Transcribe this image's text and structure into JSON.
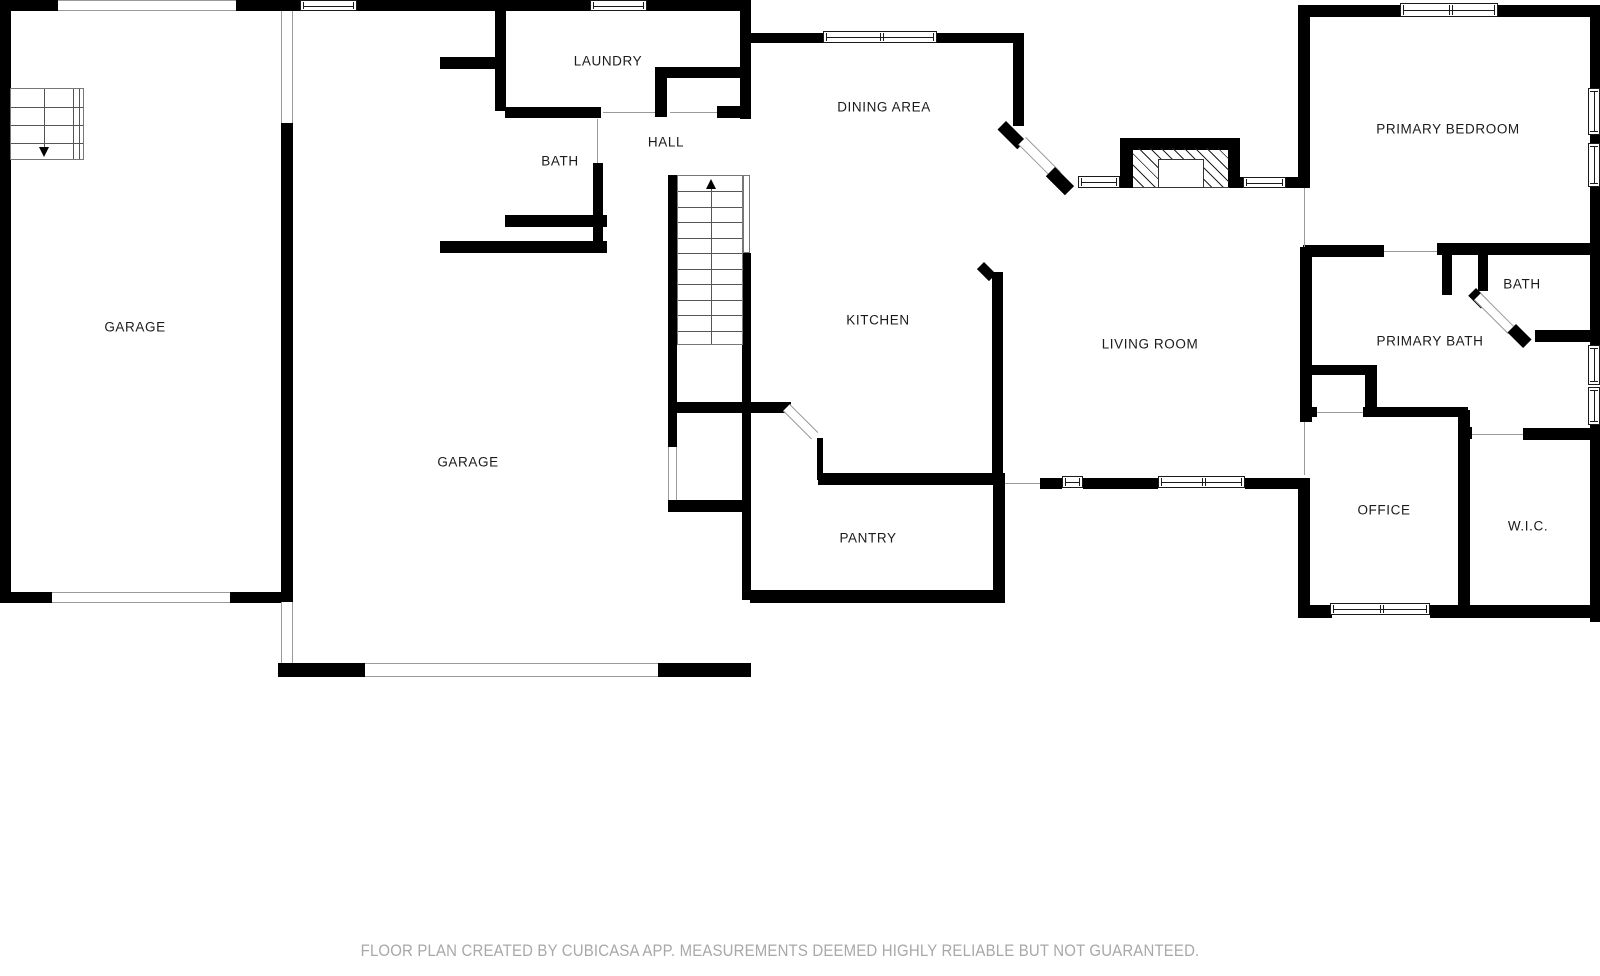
{
  "footer": {
    "text": "FLOOR PLAN CREATED BY CUBICASA APP. MEASUREMENTS DEEMED HIGHLY RELIABLE BUT NOT GUARANTEED."
  },
  "colors": {
    "wall": "#000000",
    "window_frame": "#1a1a1a",
    "opening_line": "#9b9b9b",
    "tread": "#555555",
    "label": "#1b1b1b",
    "footer_text": "#a8a8a8",
    "background": "#ffffff"
  },
  "rooms": [
    {
      "id": "garage-1",
      "label": "GARAGE",
      "x": 135,
      "y": 327
    },
    {
      "id": "garage-2",
      "label": "GARAGE",
      "x": 468,
      "y": 462
    },
    {
      "id": "laundry",
      "label": "LAUNDRY",
      "x": 608,
      "y": 61
    },
    {
      "id": "bath",
      "label": "BATH",
      "x": 560,
      "y": 161
    },
    {
      "id": "hall",
      "label": "HALL",
      "x": 666,
      "y": 142
    },
    {
      "id": "dining-area",
      "label": "DINING AREA",
      "x": 884,
      "y": 107
    },
    {
      "id": "kitchen",
      "label": "KITCHEN",
      "x": 878,
      "y": 320
    },
    {
      "id": "living-room",
      "label": "LIVING ROOM",
      "x": 1150,
      "y": 344
    },
    {
      "id": "pantry",
      "label": "PANTRY",
      "x": 868,
      "y": 538
    },
    {
      "id": "primary-bedroom",
      "label": "PRIMARY BEDROOM",
      "x": 1448,
      "y": 129
    },
    {
      "id": "bath-2",
      "label": "BATH",
      "x": 1522,
      "y": 284
    },
    {
      "id": "primary-bath",
      "label": "PRIMARY BATH",
      "x": 1430,
      "y": 341
    },
    {
      "id": "office",
      "label": "OFFICE",
      "x": 1384,
      "y": 510
    },
    {
      "id": "wic",
      "label": "W.I.C.",
      "x": 1528,
      "y": 526
    }
  ],
  "floorplan": {
    "walls": [
      [
        0,
        0,
        11,
        602
      ],
      [
        0,
        0,
        58,
        11
      ],
      [
        236,
        0,
        64,
        11
      ],
      [
        357,
        0,
        233,
        11
      ],
      [
        647,
        0,
        104,
        11
      ],
      [
        0,
        592,
        52,
        11
      ],
      [
        230,
        592,
        53,
        11
      ],
      [
        281,
        123,
        12,
        484
      ],
      [
        278,
        663,
        88,
        14
      ],
      [
        658,
        663,
        93,
        14
      ],
      [
        495,
        11,
        11,
        100
      ],
      [
        440,
        57,
        56,
        12
      ],
      [
        505,
        107,
        96,
        11
      ],
      [
        655,
        67,
        89,
        11
      ],
      [
        655,
        67,
        12,
        50
      ],
      [
        717,
        106,
        34,
        12
      ],
      [
        740,
        9,
        11,
        110
      ],
      [
        740,
        33,
        84,
        10
      ],
      [
        937,
        33,
        77,
        10
      ],
      [
        1013,
        33,
        11,
        93
      ],
      [
        1120,
        138,
        120,
        12
      ],
      [
        1120,
        145,
        13,
        43
      ],
      [
        1228,
        138,
        12,
        50
      ],
      [
        1285,
        177,
        13,
        11
      ],
      [
        1240,
        177,
        4,
        11
      ],
      [
        1298,
        5,
        104,
        12
      ],
      [
        1496,
        5,
        104,
        12
      ],
      [
        1298,
        5,
        12,
        183
      ],
      [
        1590,
        5,
        10,
        85
      ],
      [
        1590,
        134,
        10,
        10
      ],
      [
        1590,
        187,
        10,
        158
      ],
      [
        1590,
        425,
        10,
        197
      ],
      [
        1303,
        245,
        81,
        12
      ],
      [
        1437,
        243,
        163,
        12
      ],
      [
        1442,
        255,
        10,
        40
      ],
      [
        1478,
        255,
        10,
        36
      ],
      [
        1535,
        330,
        65,
        12
      ],
      [
        1300,
        247,
        12,
        175
      ],
      [
        1307,
        365,
        70,
        10
      ],
      [
        1365,
        365,
        12,
        47
      ],
      [
        1307,
        407,
        10,
        10
      ],
      [
        1363,
        407,
        105,
        10
      ],
      [
        1458,
        410,
        12,
        200
      ],
      [
        1463,
        427,
        9,
        12
      ],
      [
        1523,
        428,
        77,
        12
      ],
      [
        992,
        272,
        11,
        206
      ],
      [
        818,
        473,
        187,
        12
      ],
      [
        817,
        438,
        6,
        42
      ],
      [
        677,
        402,
        114,
        11
      ],
      [
        993,
        478,
        12,
        125
      ],
      [
        750,
        590,
        255,
        13
      ],
      [
        1040,
        478,
        22,
        11
      ],
      [
        1083,
        478,
        75,
        11
      ],
      [
        1245,
        478,
        65,
        11
      ],
      [
        1298,
        478,
        12,
        139
      ],
      [
        1298,
        605,
        34,
        13
      ],
      [
        1430,
        605,
        170,
        13
      ],
      [
        668,
        175,
        9,
        272
      ],
      [
        742,
        253,
        9,
        347
      ],
      [
        668,
        500,
        83,
        12
      ],
      [
        505,
        215,
        102,
        12
      ],
      [
        593,
        163,
        10,
        90
      ],
      [
        440,
        241,
        167,
        12
      ]
    ],
    "windows": [
      [
        300,
        0,
        57,
        11,
        1
      ],
      [
        590,
        0,
        57,
        11,
        1
      ],
      [
        823,
        31,
        114,
        12,
        2
      ],
      [
        1078,
        176,
        42,
        12,
        1
      ],
      [
        1243,
        177,
        43,
        11,
        1
      ],
      [
        1400,
        3,
        98,
        14,
        2
      ],
      [
        1588,
        88,
        12,
        47,
        1
      ],
      [
        1588,
        143,
        12,
        44,
        1
      ],
      [
        1588,
        345,
        12,
        40,
        1
      ],
      [
        1588,
        387,
        12,
        38,
        1
      ],
      [
        1062,
        476,
        21,
        12,
        1
      ],
      [
        1158,
        476,
        87,
        12,
        2
      ],
      [
        1330,
        603,
        100,
        12,
        2
      ]
    ],
    "openings": [
      [
        58,
        0,
        178,
        11,
        "h"
      ],
      [
        281,
        11,
        12,
        112,
        "v"
      ],
      [
        52,
        592,
        178,
        11,
        "h"
      ],
      [
        365,
        663,
        293,
        14,
        "h"
      ],
      [
        281,
        602,
        12,
        61,
        "v"
      ],
      [
        668,
        447,
        9,
        53,
        "v"
      ]
    ],
    "door_lines": [
      [
        603,
        112,
        52,
        "h"
      ],
      [
        670,
        112,
        47,
        "h"
      ],
      [
        597,
        119,
        44,
        "v"
      ],
      [
        1304,
        188,
        59,
        "v"
      ],
      [
        1384,
        251,
        53,
        "h"
      ],
      [
        1304,
        422,
        53,
        "v"
      ],
      [
        1317,
        412,
        46,
        "h"
      ],
      [
        1472,
        434,
        51,
        "h"
      ],
      [
        1005,
        483,
        35,
        "h"
      ]
    ],
    "diagonals": [
      {
        "x": 1006,
        "y": 121,
        "w": 28,
        "h": 12,
        "kind": "wall"
      },
      {
        "x": 1026,
        "y": 137,
        "w": 49,
        "h": 11,
        "kind": "door"
      },
      {
        "x": 1055,
        "y": 167,
        "w": 27,
        "h": 13,
        "kind": "wall"
      },
      {
        "x": 790,
        "y": 404,
        "w": 40,
        "h": 10,
        "kind": "door"
      },
      {
        "x": 984,
        "y": 262,
        "w": 17,
        "h": 10,
        "kind": "wall"
      },
      {
        "x": 1476,
        "y": 288,
        "w": 18,
        "h": 11,
        "kind": "wall"
      },
      {
        "x": 1481,
        "y": 293,
        "w": 48,
        "h": 10,
        "kind": "door"
      },
      {
        "x": 1516,
        "y": 324,
        "w": 22,
        "h": 12,
        "kind": "wall"
      }
    ],
    "fireplace": {
      "hatch": [
        1133,
        148,
        96,
        40
      ],
      "firebox": [
        1158,
        159,
        46,
        29
      ]
    },
    "stairs": {
      "main": {
        "box": [
          677,
          175,
          66,
          170
        ],
        "treads": 10,
        "center_x": 33,
        "arrow": "up",
        "rail": [
          743,
          175,
          7,
          78
        ]
      },
      "corner": {
        "box": [
          10,
          88,
          74,
          72
        ],
        "treads": 3,
        "center_x": 33,
        "arrow": "down",
        "edge_lines": [
          62,
          68
        ]
      }
    }
  }
}
